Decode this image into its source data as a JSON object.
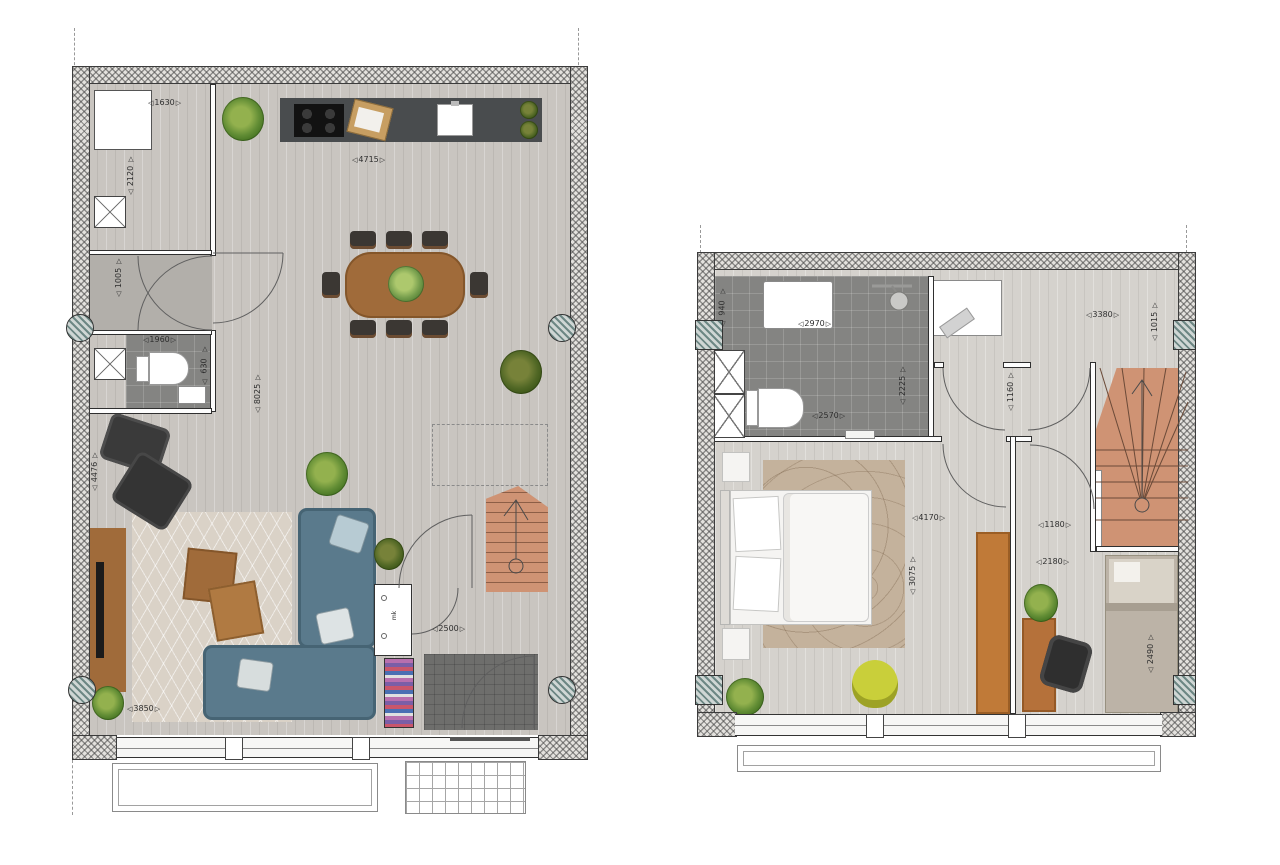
{
  "glyph": {
    "h_start": "◁",
    "h_end": "▷",
    "v_start": "△",
    "v_end": "▽"
  },
  "colors": {
    "wall_hatch": "#e4e2de",
    "floor_ground": "#c9c5c0",
    "floor_upper": "#d5d2cd",
    "tile_gray": "#848482",
    "kitchen_dark": "#494c4e",
    "wood": "#a06b3a",
    "terracotta_stairs": "#cf9374",
    "sofa_blue": "#5a7a8c",
    "chair_yellow": "#c9cf3a",
    "column_teal": "#6d8784"
  },
  "ground_floor": {
    "label": "ground-floor-plan",
    "dims": {
      "cabinet_width": "1630",
      "closet_height": "2120",
      "hall_depth": "1005",
      "wc_width": "1960",
      "wc_depth": "630",
      "kitchen_width": "4715",
      "living_depth": "8025",
      "living_side_height": "4476",
      "sofa_wall_width": "3850",
      "entry_width": "2500",
      "meter_closet_label": "mk"
    }
  },
  "upper_floor": {
    "label": "upper-floor-plan",
    "dims": {
      "bath_niche_height": "940",
      "bath_width_top": "2970",
      "bath_width_bottom": "2570",
      "bath_depth": "2225",
      "landing_width": "3380",
      "landing_depth": "1015",
      "corridor_depth": "1160",
      "bedroom_width": "4170",
      "bedroom_depth": "3075",
      "study_width_top": "1180",
      "study_width": "2180",
      "bed_length": "2490"
    }
  }
}
